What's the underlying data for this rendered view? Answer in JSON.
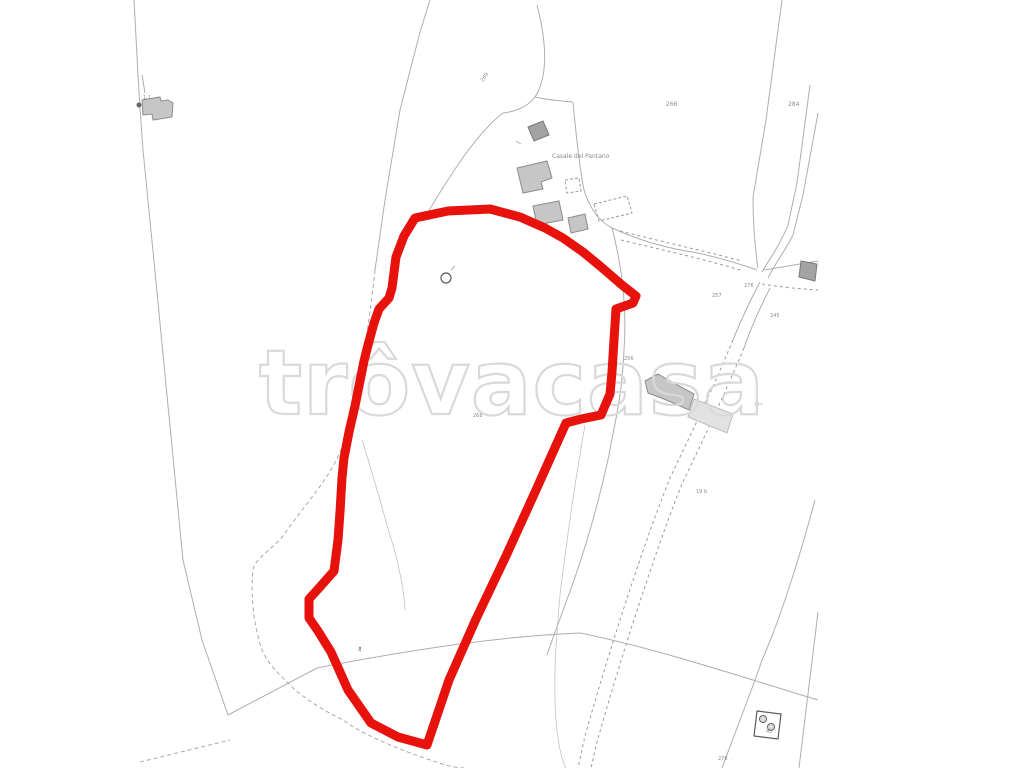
{
  "page": {
    "description": "Cadastral land-registry map with highlighted parcel",
    "background": "#ffffff"
  },
  "watermark": {
    "text": "trôvacasa",
    "tm": "™",
    "color": "#d9d9d9"
  },
  "parcel": {
    "color": "#e8120c",
    "stroke_width": "9",
    "path": "M415,218 L448,211 L490,209 L520,217 L545,228 L563,238 L583,252 L600,266 L622,285 L636,296 L633,303 L616,309 L614,340 L612,372 L610,394 L601,415 L581,419 L566,423 L536,490 L506,556 L476,619 L449,680 L427,745 L398,737 L371,723 L348,690 L331,652 L318,631 L309,618 L309,599 L319,588 L334,571 L338,540 L340,512 L342,478 L344,458 L349,432 L355,406 L359,386 L364,361 L368,345 L374,323 L379,309 L389,298 L392,288 L396,257 L404,236 Z"
  },
  "map": {
    "line_color": "#aeaeae",
    "building_fill": "#c6c6c6",
    "labels": [
      {
        "text": "1.1",
        "x": 143,
        "y": 99,
        "size": 5
      },
      {
        "text": "269",
        "x": 483,
        "y": 82,
        "size": 5,
        "rotate": -55
      },
      {
        "text": "266",
        "x": 666,
        "y": 106,
        "size": 6
      },
      {
        "text": "284",
        "x": 788,
        "y": 106,
        "size": 6
      },
      {
        "text": "Casale del Pantano",
        "x": 552,
        "y": 158,
        "size": 6
      },
      {
        "text": "257",
        "x": 712,
        "y": 297,
        "size": 5
      },
      {
        "text": "276",
        "x": 744,
        "y": 287,
        "size": 5
      },
      {
        "text": "245",
        "x": 770,
        "y": 317,
        "size": 5
      },
      {
        "text": "256",
        "x": 624,
        "y": 360,
        "size": 5
      },
      {
        "text": "268",
        "x": 473,
        "y": 417,
        "size": 5
      },
      {
        "text": "19 b",
        "x": 696,
        "y": 493,
        "size": 5
      },
      {
        "text": "4",
        "x": 358,
        "y": 652,
        "size": 5
      },
      {
        "text": "43",
        "x": 766,
        "y": 733,
        "size": 5
      },
      {
        "text": "278",
        "x": 718,
        "y": 760,
        "size": 5
      }
    ]
  }
}
